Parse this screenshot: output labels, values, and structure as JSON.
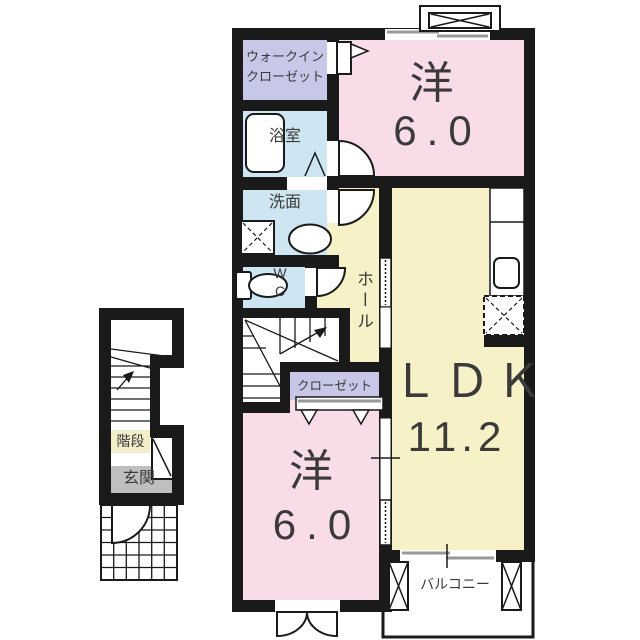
{
  "floor_plan": {
    "type": "apartment-2F-madori",
    "colors": {
      "wall": "#1a1a1a",
      "pink": "#f8dce8",
      "lavender": "#c7c7e7",
      "blue": "#cde6f2",
      "yellow": "#f6f1c6",
      "cream": "#f3edc9",
      "gray": "#bfbfbf",
      "gray_line": "#999999",
      "white": "#ffffff",
      "text": "#3a3a3a"
    },
    "rooms": {
      "walk_in_closet": {
        "label_line1": "ウォークイン",
        "label_line2": "クローゼット"
      },
      "bathroom": {
        "label": "浴室"
      },
      "washroom": {
        "label": "洗面"
      },
      "toilet": {
        "label_line1": "W",
        "label_line2": "C"
      },
      "hall": {
        "label": "ホール"
      },
      "closet": {
        "label": "クローゼット"
      },
      "bedroom_top": {
        "label": "洋",
        "size": "6.0"
      },
      "ldk": {
        "label": "ＬＤＫ",
        "size": "11.2"
      },
      "bedroom_bottom": {
        "label": "洋",
        "size": "6.0"
      },
      "balcony": {
        "label": "バルコニー"
      },
      "stairs": {
        "label": "階段"
      },
      "entrance": {
        "label": "玄関"
      }
    }
  }
}
